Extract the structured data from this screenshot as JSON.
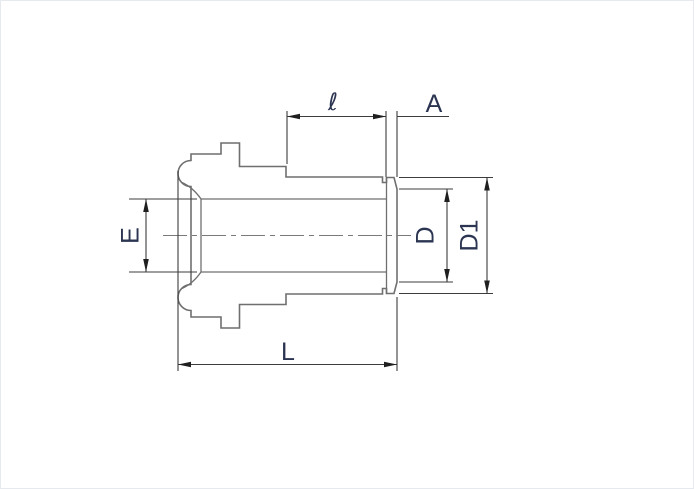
{
  "diagram": {
    "title": "tube gland fitting dimensional drawing",
    "labels": {
      "stub_length": "ℓ",
      "flange_thickness": "A",
      "bore_diameter": "E",
      "face_diameter": "D",
      "flange_diameter": "D1",
      "overall_length": "L"
    },
    "colors": {
      "outline": "#6f6f6f",
      "inner_line": "#6f6f6f",
      "centerline": "#7a7a7a",
      "dimension_line": "#3d3d3d",
      "arrow": "#1f1f1f",
      "label": "#2b3450",
      "background": "#ffffff"
    }
  }
}
